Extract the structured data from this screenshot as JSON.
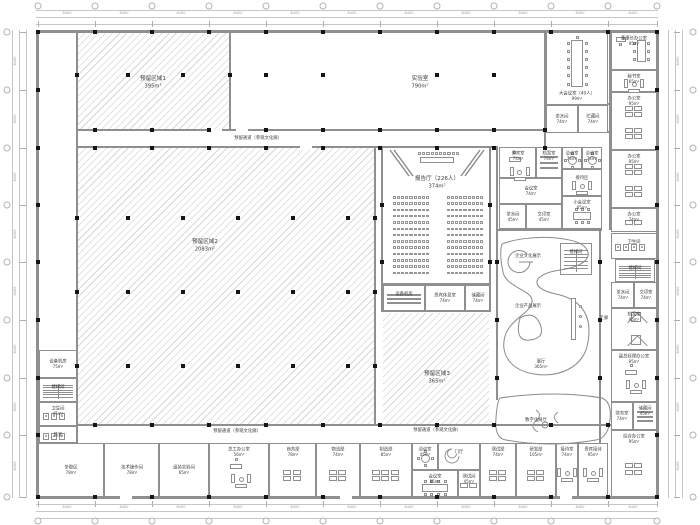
{
  "drawing": {
    "type": "architectural-floor-plan"
  },
  "colors": {
    "wall": "#8f8f8f",
    "column": "#151515",
    "hatch": "#969696",
    "dim": "#c6c6c6",
    "text": "#3a3a3a"
  },
  "dims": {
    "bay": "8400"
  },
  "zones": [
    {
      "x": 78,
      "y": 32,
      "w": 151,
      "h": 97,
      "hatch": true
    },
    {
      "x": 231,
      "y": 32,
      "w": 313,
      "h": 97,
      "hatch": false
    },
    {
      "x": 78,
      "y": 148,
      "w": 296,
      "h": 276,
      "hatch": true
    },
    {
      "x": 383,
      "y": 313,
      "w": 106,
      "h": 111,
      "hatch": true
    }
  ],
  "labels": [
    {
      "t": "预留区域1",
      "a": "395m²",
      "x": 153,
      "y": 82,
      "z": 1
    },
    {
      "t": "实验室",
      "a": "790m²",
      "x": 420,
      "y": 82,
      "z": 1
    },
    {
      "t": "预留区域2",
      "a": "2083m²",
      "x": 205,
      "y": 245,
      "z": 1
    },
    {
      "t": "预留区域3",
      "a": "365m²",
      "x": 437,
      "y": 377,
      "z": 1
    },
    {
      "t": "报告厅（226人）",
      "a": "374m²",
      "x": 437,
      "y": 182,
      "z": 1
    },
    {
      "t": "预留通道（参观文化廊）",
      "x": 258,
      "y": 138
    },
    {
      "t": "预留通道（参观文化廊）",
      "x": 237,
      "y": 431
    },
    {
      "t": "预留通道（参观文化廊）",
      "x": 437,
      "y": 430
    },
    {
      "t": "企业文化展示",
      "x": 528,
      "y": 256
    },
    {
      "t": "企业产品展示",
      "x": 528,
      "y": 306
    },
    {
      "t": "展厅",
      "a": "365m²",
      "x": 541,
      "y": 364
    },
    {
      "t": "数字化展厅",
      "x": 536,
      "y": 420
    },
    {
      "t": "走廊",
      "x": 604,
      "y": 318
    }
  ],
  "rooms": [
    {
      "n": "大会议室（40人）",
      "a": "99m²",
      "x": 546,
      "y": 32,
      "w": 62,
      "h": 73,
      "f": "tableV",
      "lp": "b"
    },
    {
      "n": "茶水间",
      "a": "74m²",
      "x": 546,
      "y": 105,
      "w": 32,
      "h": 28
    },
    {
      "n": "贮藏间",
      "a": "74m²",
      "x": 578,
      "y": 105,
      "w": 30,
      "h": 28
    },
    {
      "n": "董事长办公室",
      "a": "95m²",
      "x": 611,
      "y": 32,
      "w": 46,
      "h": 38,
      "f": "deskMeet"
    },
    {
      "n": "秘书室",
      "a": "65m²",
      "x": 611,
      "y": 70,
      "w": 46,
      "h": 22,
      "f": "sofa"
    },
    {
      "n": "办公室",
      "a": "95m²",
      "x": 611,
      "y": 92,
      "w": 46,
      "h": 58,
      "f": "desks8"
    },
    {
      "n": "办公室",
      "a": "95m²",
      "x": 611,
      "y": 150,
      "w": 46,
      "h": 58,
      "f": "desks8"
    },
    {
      "n": "办公室",
      "a": "74m²",
      "x": 611,
      "y": 208,
      "w": 46,
      "h": 24,
      "f": "desks2"
    },
    {
      "n": "贵宾室",
      "a": "74m²",
      "x": 499,
      "y": 147,
      "w": 37,
      "h": 31,
      "f": "deskSofa"
    },
    {
      "n": "档案室",
      "a": "74m²",
      "x": 536,
      "y": 147,
      "w": 26,
      "h": 31,
      "f": "shelves"
    },
    {
      "n": "洽谈室",
      "a": "74m²",
      "x": 562,
      "y": 147,
      "w": 20,
      "h": 22,
      "f": "round"
    },
    {
      "n": "洽谈室",
      "a": "74m²",
      "x": 582,
      "y": 147,
      "w": 20,
      "h": 22,
      "f": "round"
    },
    {
      "n": "会议室",
      "a": "74m²",
      "x": 499,
      "y": 178,
      "w": 63,
      "h": 26
    },
    {
      "n": "接待区",
      "x": 562,
      "y": 169,
      "w": 40,
      "h": 27,
      "f": "sofa"
    },
    {
      "n": "茶水间",
      "a": "45m²",
      "x": 499,
      "y": 204,
      "w": 27,
      "h": 25
    },
    {
      "n": "文印室",
      "a": "45m²",
      "x": 526,
      "y": 204,
      "w": 36,
      "h": 25
    },
    {
      "n": "小会议室",
      "a": "65m²",
      "x": 562,
      "y": 196,
      "w": 40,
      "h": 33,
      "f": "table8"
    },
    {
      "n": "设备机房",
      "x": 383,
      "y": 285,
      "w": 42,
      "h": 26,
      "f": "shelves"
    },
    {
      "n": "贵宾休息室",
      "a": "74m²",
      "x": 425,
      "y": 285,
      "w": 40,
      "h": 26
    },
    {
      "n": "储藏间",
      "a": "74m²",
      "x": 465,
      "y": 285,
      "w": 25,
      "h": 26
    },
    {
      "n": "设备机房",
      "a": "75m²",
      "x": 39,
      "y": 350,
      "w": 38,
      "h": 28
    },
    {
      "n": "楼梯间",
      "x": 39,
      "y": 378,
      "w": 38,
      "h": 24,
      "f": "stairs"
    },
    {
      "n": "卫生间",
      "a": "45m²",
      "x": 39,
      "y": 402,
      "w": 38,
      "h": 24,
      "f": "wc"
    },
    {
      "n": "前室",
      "x": 39,
      "y": 426,
      "w": 38,
      "h": 17,
      "f": "wc"
    },
    {
      "n": "茶歇区",
      "a": "78m²",
      "x": 38,
      "y": 443,
      "w": 66,
      "h": 54
    },
    {
      "n": "技术操作间",
      "a": "78m²",
      "x": 104,
      "y": 443,
      "w": 55,
      "h": 54
    },
    {
      "n": "组装实验间",
      "a": "65m²",
      "x": 159,
      "y": 443,
      "w": 50,
      "h": 54
    },
    {
      "n": "总工办公室",
      "a": "56m²",
      "x": 209,
      "y": 443,
      "w": 60,
      "h": 54,
      "f": "deskSofa"
    },
    {
      "n": "商务部",
      "a": "78m²",
      "x": 269,
      "y": 443,
      "w": 47,
      "h": 54,
      "f": "desks4"
    },
    {
      "n": "物流部",
      "a": "74m²",
      "x": 316,
      "y": 443,
      "w": 44,
      "h": 54,
      "f": "desks4"
    },
    {
      "n": "制造部",
      "a": "85m²",
      "x": 360,
      "y": 443,
      "w": 52,
      "h": 54,
      "f": "desks6"
    },
    {
      "n": "洽谈室",
      "a": "45m²",
      "x": 412,
      "y": 443,
      "w": 26,
      "h": 27,
      "f": "round"
    },
    {
      "n": "门厅",
      "x": 438,
      "y": 443,
      "w": 42,
      "h": 27,
      "f": "spiral"
    },
    {
      "n": "会议室",
      "a": "85m²",
      "x": 412,
      "y": 470,
      "w": 46,
      "h": 27,
      "f": "table12"
    },
    {
      "n": "测试间",
      "a": "45m²",
      "x": 458,
      "y": 470,
      "w": 22,
      "h": 27,
      "f": "desks2"
    },
    {
      "n": "测试部",
      "a": "74m²",
      "x": 480,
      "y": 443,
      "w": 36,
      "h": 54,
      "f": "desks4"
    },
    {
      "n": "研发部",
      "a": "105m²",
      "x": 516,
      "y": 443,
      "w": 40,
      "h": 54,
      "f": "desks4"
    },
    {
      "n": "接待室",
      "a": "74m²",
      "x": 556,
      "y": 443,
      "w": 22,
      "h": 54,
      "f": "sofa"
    },
    {
      "n": "贵宾接待",
      "a": "95m²",
      "x": 578,
      "y": 443,
      "w": 30,
      "h": 54,
      "f": "sofa"
    },
    {
      "n": "综合办公室",
      "a": "95m²",
      "x": 611,
      "y": 430,
      "w": 46,
      "h": 67,
      "f": "desks4"
    },
    {
      "n": "卫生间",
      "x": 611,
      "y": 233,
      "w": 46,
      "h": 26,
      "f": "wc"
    },
    {
      "n": "楼梯间",
      "x": 615,
      "y": 259,
      "w": 40,
      "h": 23,
      "f": "stairs"
    },
    {
      "n": "茶水间",
      "a": "74m²",
      "x": 611,
      "y": 282,
      "w": 23,
      "h": 26
    },
    {
      "n": "文印室",
      "a": "74m²",
      "x": 634,
      "y": 282,
      "w": 23,
      "h": 26
    },
    {
      "n": "档案室",
      "a": "95m²",
      "x": 611,
      "y": 308,
      "w": 46,
      "h": 42,
      "f": "shaft"
    },
    {
      "n": "副总经理办公室",
      "a": "95m²",
      "x": 611,
      "y": 350,
      "w": 46,
      "h": 52,
      "f": "deskSofa"
    },
    {
      "n": "财务室",
      "a": "74m²",
      "x": 611,
      "y": 402,
      "w": 22,
      "h": 28
    },
    {
      "n": "储藏间",
      "a": "45m²",
      "x": 633,
      "y": 402,
      "w": 24,
      "h": 28,
      "f": "shelves"
    },
    {
      "n": "楼梯间",
      "x": 560,
      "y": 243,
      "w": 32,
      "h": 32,
      "f": "stairs"
    }
  ],
  "auditorium": {
    "rows": 13,
    "seats_per_block": 9,
    "dais_seats": 10
  }
}
